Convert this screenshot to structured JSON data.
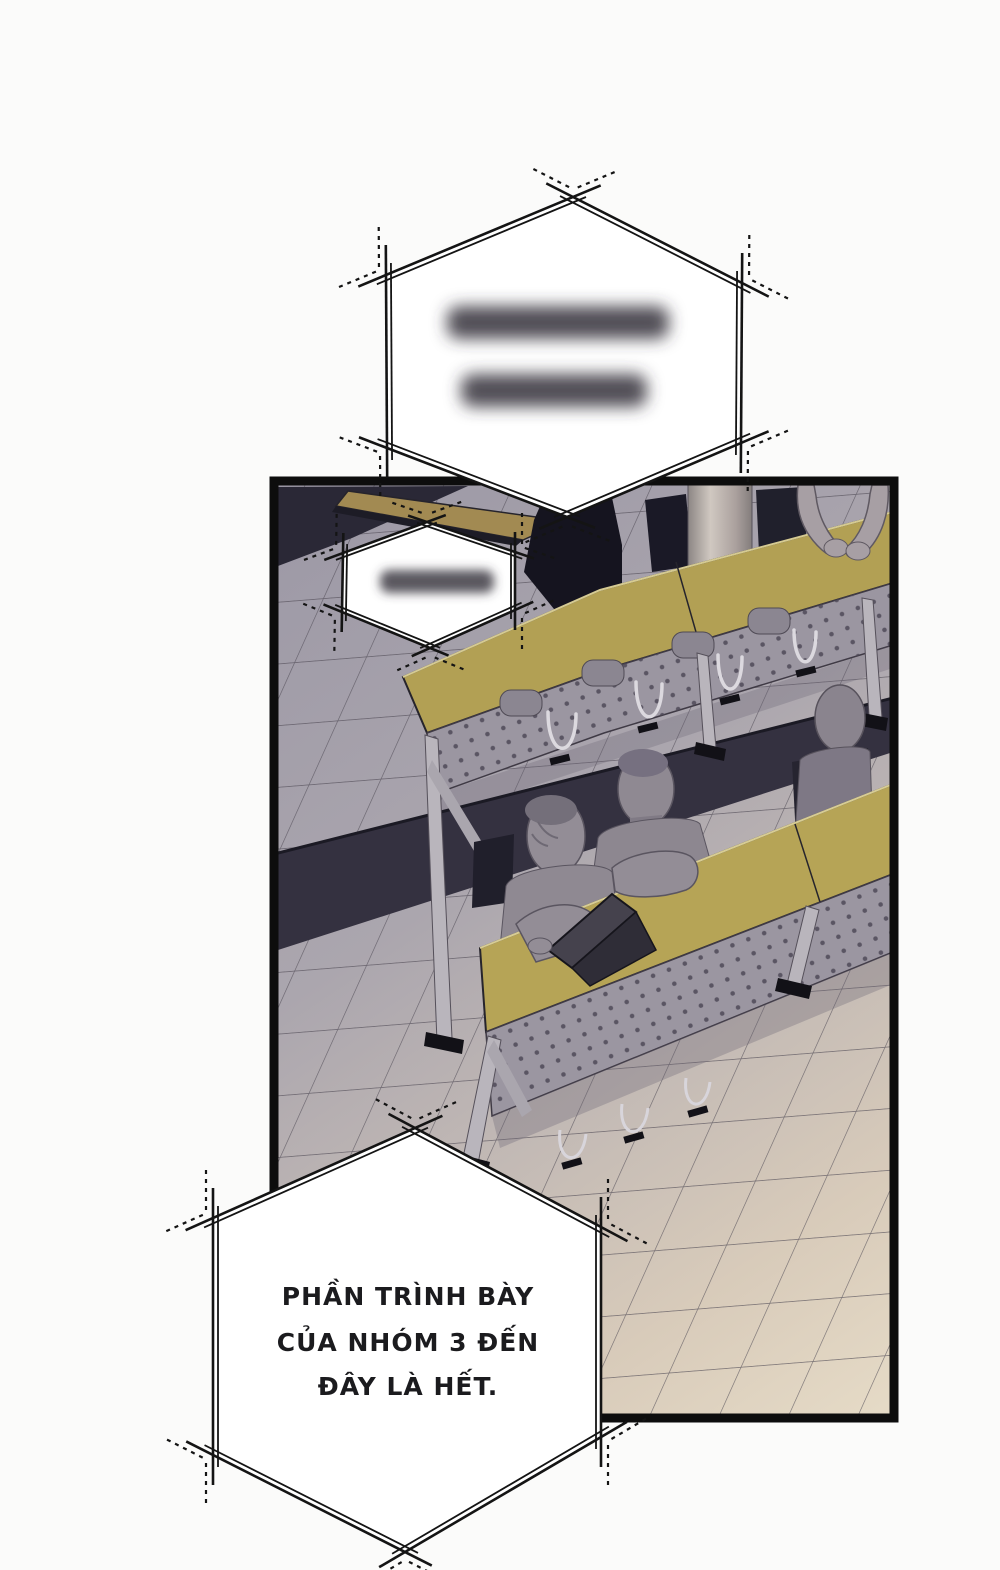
{
  "page": {
    "kind": "comic-page",
    "background_color": "#fbfbfa"
  },
  "speech_bubbles": {
    "top": {
      "shape": "hexagon-double-outline",
      "content": "blurred (unreadable)",
      "blurred": true,
      "blurred_line_count": 2
    },
    "panel_inner": {
      "shape": "hexagon-double-outline",
      "content": "blurred (unreadable)",
      "blurred": true,
      "blurred_line_count": 1
    },
    "bottom": {
      "shape": "hexagon-double-outline",
      "blurred": false,
      "lines": [
        "PHẦN TRÌNH BÀY",
        "CỦA NHÓM 3 ĐẾN",
        "ĐÂY LÀ HẾT."
      ]
    }
  },
  "panel": {
    "scene": "isometric classroom viewed from above: three long desks with olive tops and perforated fronts, tiled floor, dark chairs, four gray figures, one open laptop, a column",
    "desk_rows_visible": 3,
    "figures_visible": 4,
    "laptop_count": 1,
    "colors": {
      "desk_top": "#b5a358",
      "desk_top_far_row": "#a28a52",
      "desk_front_panel": "#9b96a1",
      "floor_near": "#a29ea9",
      "floor_far": "#e0d5c2",
      "shadow_band": "#343140",
      "chair": "#1a1926",
      "figure": "#8f8992",
      "panel_border": "#0d0d0d",
      "bubble_fill": "#ffffff",
      "bubble_outline": "#141414"
    }
  }
}
